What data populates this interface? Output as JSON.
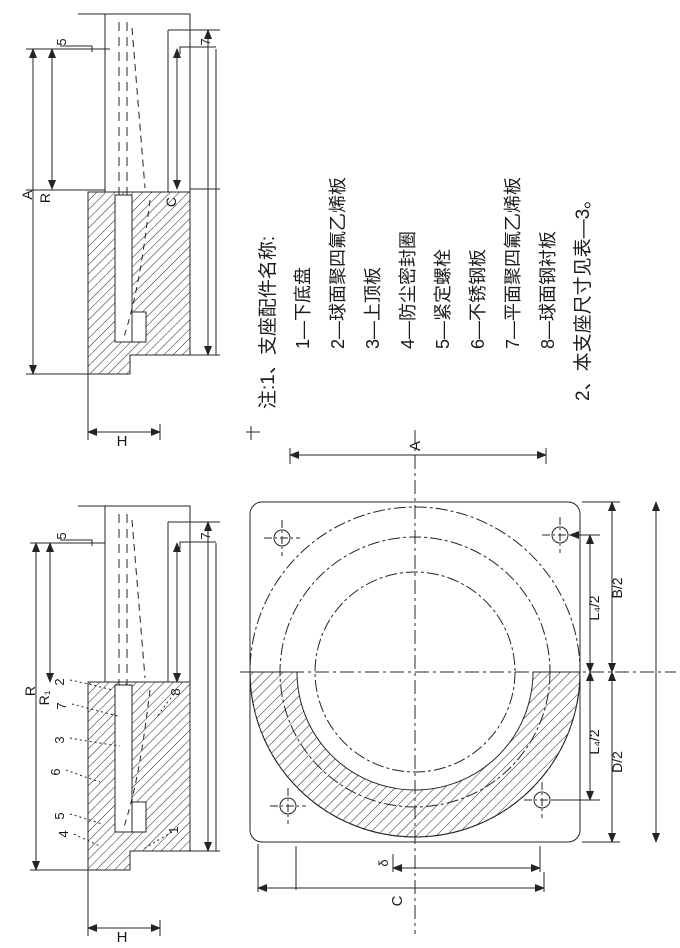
{
  "colors": {
    "ink": "#242424",
    "paper": "#ffffff"
  },
  "notes": {
    "title": "注:1、支座配件名称:",
    "items": [
      "1—下底盘",
      "2—球面聚四氟乙烯板",
      "3—上顶板",
      "4—防尘密封圈",
      "5—紧定螺栓",
      "6—不锈钢板",
      "7—平面聚四氟乙烯板",
      "8—球面钢衬板"
    ],
    "footer": "2、本支座尺寸见表—3。"
  },
  "section_top": {
    "dims": {
      "left_outer": "A",
      "left_inner": "R",
      "right": "C",
      "top_left": "5",
      "top_right": "7",
      "bottom": "H"
    }
  },
  "section_bottom": {
    "dims": {
      "left_outer": "R",
      "left_inner": "R₁",
      "top_left": "5",
      "top_right": "7",
      "bottom": "H"
    },
    "callouts_left": [
      "2",
      "7",
      "3",
      "6",
      "5",
      "4"
    ],
    "callouts_right": [
      "8",
      "1"
    ]
  },
  "plan": {
    "dims": {
      "top": "A",
      "right_upper_inner": "L₄/2",
      "right_upper_outer": "B/2",
      "right_lower_inner": "L₄/2",
      "right_lower_outer": "D/2",
      "bottom_short": "δ",
      "bottom_long": "C"
    }
  }
}
